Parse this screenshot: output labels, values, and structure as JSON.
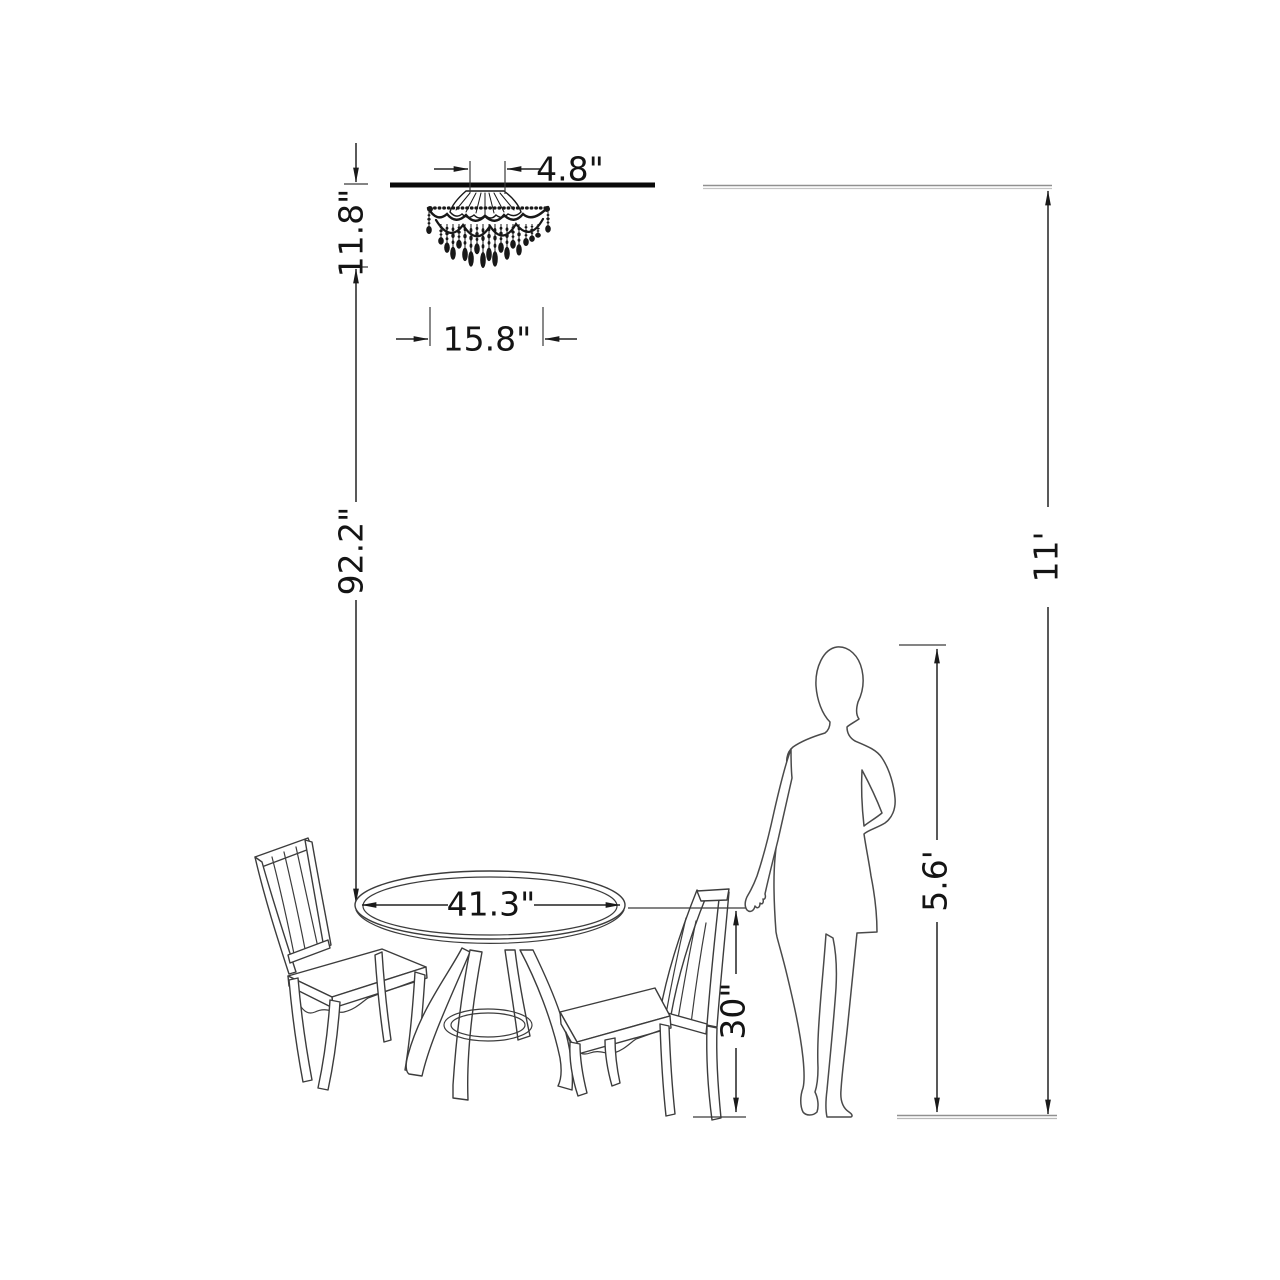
{
  "diagram": {
    "type": "furniture-dimension-diagram",
    "dimensions": {
      "canopy_width": "4.8\"",
      "fixture_height": "11.8\"",
      "fixture_width": "15.8\"",
      "fixture_to_table": "92.2\"",
      "ceiling_height": "11'",
      "table_diameter": "41.3\"",
      "table_height": "30\"",
      "person_height": "5.6'"
    },
    "colors": {
      "background": "#ffffff",
      "line": "#222222",
      "text": "#141414",
      "reference_line": "#909090"
    }
  }
}
